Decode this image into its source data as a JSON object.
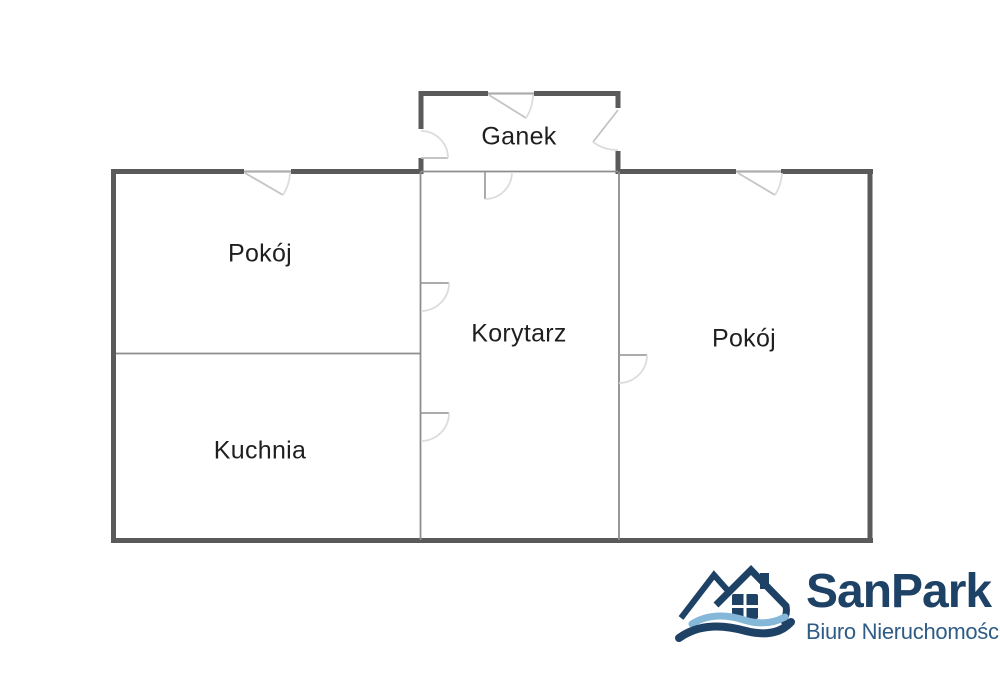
{
  "floorplan": {
    "rooms": [
      {
        "id": "ganek",
        "label": "Ganek"
      },
      {
        "id": "pokoj_left",
        "label": "Pokój"
      },
      {
        "id": "korytarz",
        "label": "Korytarz"
      },
      {
        "id": "pokoj_right",
        "label": "Pokój"
      },
      {
        "id": "kuchnia",
        "label": "Kuchnia"
      }
    ],
    "symbols": {
      "door_swing_icon": "quarter-circle swing arc",
      "window_swing_icon": "angled swing arc"
    },
    "colors": {
      "wall": "#5a5a5a",
      "partition": "#8d8d8d",
      "door_leaf": "#a0a0a0",
      "door_arc": "#dcdcdc",
      "text": "#1f1f1f",
      "background": "#ffffff"
    }
  },
  "branding": {
    "logo_text": "SanPark",
    "logo_subtitle": "Biuro Nieruchomości",
    "logo_icon": "house-with-waves-icon",
    "colors": {
      "navy": "#1e4166",
      "light_blue": "#85b7d9"
    }
  }
}
